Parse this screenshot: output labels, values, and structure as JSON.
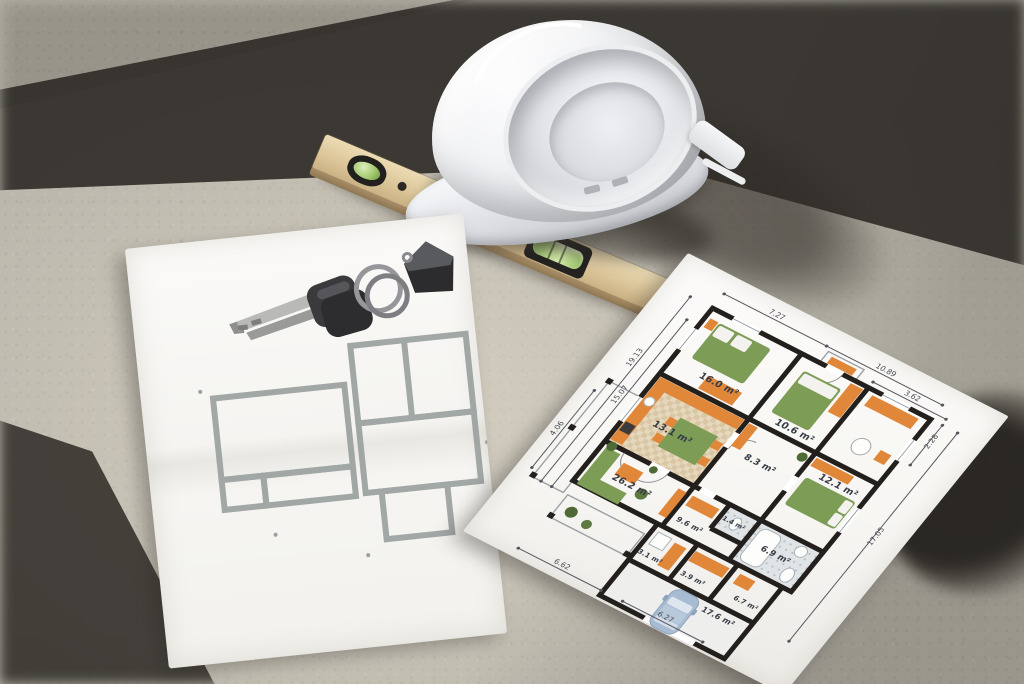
{
  "scene": {
    "setting": "concrete floor with sunlight and hard shadows"
  },
  "blueprint": {
    "rooms": [
      {
        "name": "bedroom-1",
        "area": "16.0 m²"
      },
      {
        "name": "bedroom-2",
        "area": "10.6 m²"
      },
      {
        "name": "kitchen-dining",
        "area": "13.1 m²"
      },
      {
        "name": "hall",
        "area": "8.3 m²"
      },
      {
        "name": "bedroom-3",
        "area": "12.1 m²"
      },
      {
        "name": "bathroom",
        "area": "6.9 m²"
      },
      {
        "name": "wc",
        "area": "1.4 m²"
      },
      {
        "name": "corridor",
        "area": "9.6 m²"
      },
      {
        "name": "living-room",
        "area": "26.2 m²"
      },
      {
        "name": "storage",
        "area": "6.7 m²"
      },
      {
        "name": "utility",
        "area": "3.1 m²"
      },
      {
        "name": "hallway",
        "area": "3.9 m²"
      },
      {
        "name": "garage",
        "area": "17.6 m²"
      }
    ],
    "dims": {
      "top_left": "7.27",
      "top_right": "10.89",
      "upper_right": "3.62",
      "right_small": "2.28",
      "right_tall": "17.05",
      "left_outer": "19.13",
      "left_inner": "15.07",
      "left_bottom": "4.06",
      "bottom_left": "6.62",
      "bottom_right": "6.27"
    }
  },
  "colors": {
    "furniture_orange": "#e0873a",
    "furniture_green": "#7d9c55",
    "plant_green": "#4e6b35",
    "wall_black": "#221f1c",
    "car_blue": "#a7bbd2",
    "vial_green": "#9cc468",
    "level_wood": "#dcc69a",
    "sketch_gray": "#9aa19f",
    "concrete": "#b9b5aa"
  }
}
